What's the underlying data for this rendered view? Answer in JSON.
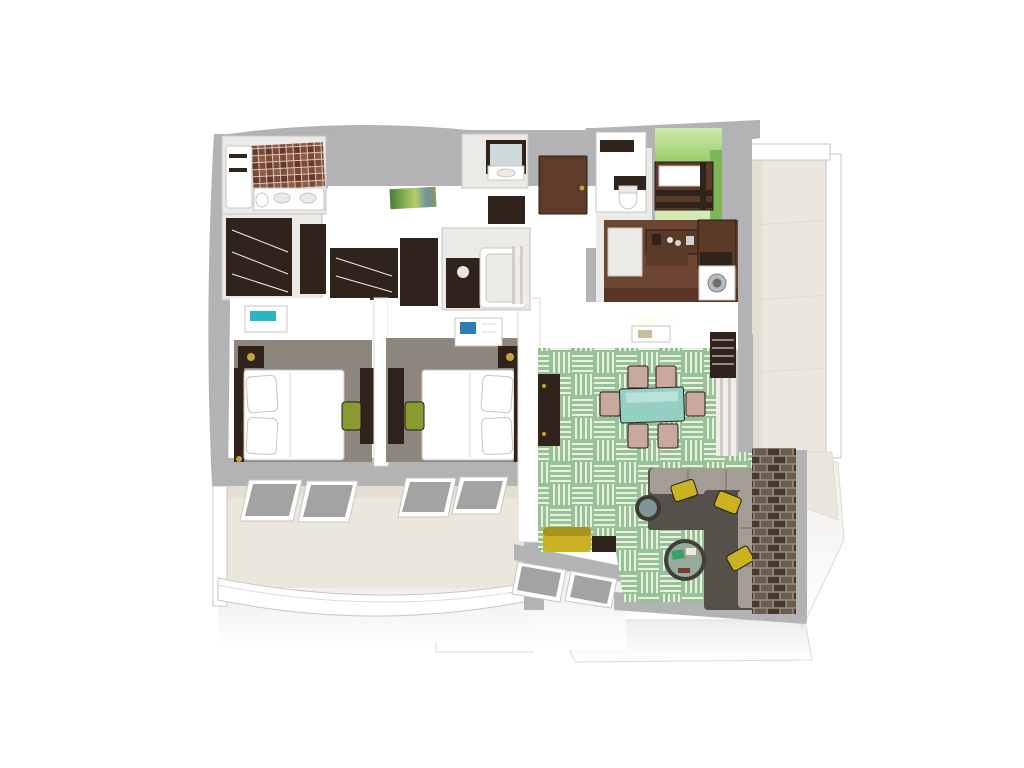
{
  "scene": {
    "kind": "3d-floor-plan-rendering",
    "view": "isometric-top-down",
    "background": "white",
    "rooms": [
      {
        "id": "master-bathroom",
        "features": [
          "brick-mosaic-tile-floor",
          "bathtub",
          "towel-racks",
          "double-sink-counter",
          "toilet"
        ]
      },
      {
        "id": "wardrobe-hall",
        "features": [
          "dark-espresso-closets",
          "white-shelving"
        ]
      },
      {
        "id": "hallway",
        "features": [
          "rainbow-runner-rug",
          "white-floor"
        ]
      },
      {
        "id": "vanity-niche",
        "features": [
          "dark-framed-mirror",
          "white-sink"
        ]
      },
      {
        "id": "guest-bathroom",
        "features": [
          "dark-vanity",
          "bathtub",
          "striped-shower-curtain",
          "wall-cabinet"
        ]
      },
      {
        "id": "entry",
        "features": [
          "brown-entry-door"
        ]
      },
      {
        "id": "water-closet",
        "features": [
          "toilet",
          "dark-mirror-shelf"
        ]
      },
      {
        "id": "bunk-room",
        "features": [
          "green-accent-walls",
          "dark-wood-bunk-bed",
          "white-bedding"
        ]
      },
      {
        "id": "kitchenette",
        "features": [
          "red-brown-wood-floor",
          "coffee-counter",
          "tall-cabinet",
          "microwave",
          "washer-dryer",
          "cream-cabinets"
        ]
      },
      {
        "id": "inner-hall",
        "features": [
          "ceiling-light-glow",
          "wall-art"
        ]
      },
      {
        "id": "bedroom-1",
        "features": [
          "gray-carpet",
          "double-bed-white-linens",
          "dark-headboard",
          "nightstand-lamp",
          "desk",
          "olive-chair",
          "teal-top-bench"
        ]
      },
      {
        "id": "bedroom-2",
        "features": [
          "gray-carpet",
          "double-bed-white-linens",
          "dark-headboard",
          "nightstand-lamp",
          "desk",
          "olive-chair",
          "blue-wall-art"
        ]
      },
      {
        "id": "living-dining-room",
        "features": [
          "green-basketweave-carpet",
          "teal-glass-dining-table",
          "six-blush-chairs",
          "media-console",
          "slat-wardrobe",
          "window-curtain",
          "l-shaped-sectional-sofa",
          "yellow-throw-pillows",
          "round-side-table",
          "round-glass-coffee-table",
          "brick-accent-wall",
          "yellow-chaise",
          "side-table"
        ]
      },
      {
        "id": "balcony-south",
        "features": [
          "cream-floor",
          "tilted-window-row",
          "curved-glass-railing"
        ]
      },
      {
        "id": "balcony-east",
        "features": [
          "cream-floor",
          "white-railing"
        ]
      }
    ]
  },
  "colors": {
    "wall_gray": "#b3b2b4",
    "wall_gray_dark": "#a2a1a3",
    "wall_shadow": "#eceae6",
    "floor_cream": "#ece7dc",
    "floor_cream_dark": "#ddd7c9",
    "carpet_taupe": "#8d867e",
    "carpet_green": "#97c298",
    "carpet_stripe": "#e9f0df",
    "wood_espresso": "#30231b",
    "wood_brown": "#5c3a28",
    "kitchen_floor": "#6e4432",
    "door_brown": "#5e3c28",
    "green_wall": "#7cb85a",
    "green_wall_light": "#bce09a",
    "green_floor": "#d5e9b6",
    "olive_chair": "#8a9a2e",
    "yellow_accent": "#c9b322",
    "sofa_dark": "#55504a",
    "sofa_light": "#a39d96",
    "blush_chair": "#c9a89f",
    "teal_glass": "#93cfc2",
    "teal_accent": "#2ab4c6",
    "art_blue": "#2e7fb4",
    "lamp_gold": "#c8a23c",
    "window_glass": "#a3a3a1",
    "brick_a": "#6b5c4e",
    "brick_b": "#423930",
    "brick_mortar": "#94897b",
    "tile_a": "#7c4936",
    "tile_b": "#915c46",
    "tile_c": "#66382a"
  }
}
